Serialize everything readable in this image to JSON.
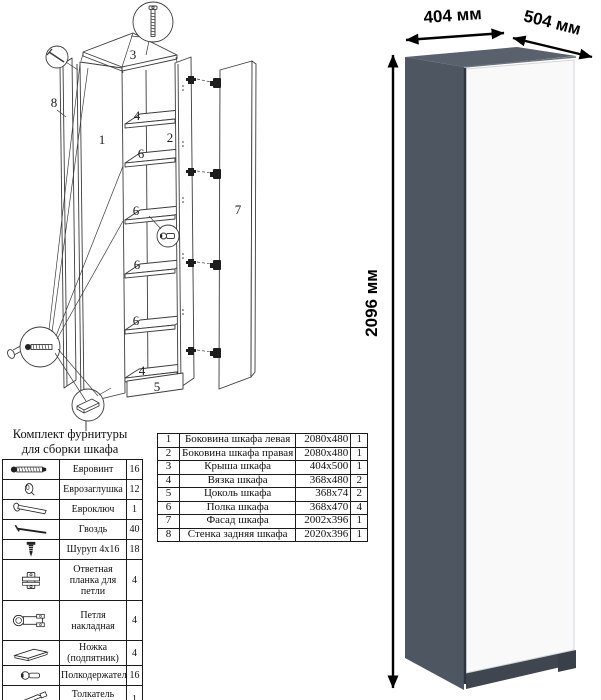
{
  "diagram": {
    "numbers": {
      "1": "1",
      "2": "2",
      "3": "3",
      "4": "4",
      "5": "5",
      "6": "6",
      "7": "7",
      "8": "8"
    }
  },
  "hardware_kit": {
    "title_line1": "Комплект фурнитуры",
    "title_line2": "для сборки шкафа",
    "items": [
      {
        "icon": "euro-screw-icon",
        "name": "Евровинт",
        "qty": "16"
      },
      {
        "icon": "cap-icon",
        "name": "Еврозаглушка",
        "qty": "12"
      },
      {
        "icon": "hex-key-icon",
        "name": "Евроключ",
        "qty": "1"
      },
      {
        "icon": "nail-icon",
        "name": "Гвоздь",
        "qty": "40"
      },
      {
        "icon": "screw-icon",
        "name": "Шуруп 4x16",
        "qty": "18"
      },
      {
        "icon": "hinge-plate-icon",
        "name": "Ответная планка для петли",
        "qty": "4"
      },
      {
        "icon": "hinge-icon",
        "name": "Петля накладная",
        "qty": "4"
      },
      {
        "icon": "foot-icon",
        "name": "Ножка (подпятник)",
        "qty": "4"
      },
      {
        "icon": "shelf-pin-icon",
        "name": "Полкодержатель",
        "qty": "16"
      },
      {
        "icon": "push-rod-icon",
        "name": "Толкатель (пуш)",
        "qty": "1"
      }
    ]
  },
  "parts_table": {
    "rows": [
      {
        "num": "1",
        "name": "Боковина шкафа левая",
        "size": "2080x480",
        "qty": "1"
      },
      {
        "num": "2",
        "name": "Боковина шкафа правая",
        "size": "2080x480",
        "qty": "1"
      },
      {
        "num": "3",
        "name": "Крыша шкафа",
        "size": "404x500",
        "qty": "1"
      },
      {
        "num": "4",
        "name": "Вязка шкафа",
        "size": "368x480",
        "qty": "2"
      },
      {
        "num": "5",
        "name": "Цоколь шкафа",
        "size": "368x74",
        "qty": "2"
      },
      {
        "num": "6",
        "name": "Полка шкафа",
        "size": "368x470",
        "qty": "4"
      },
      {
        "num": "7",
        "name": "Фасад шкафа",
        "size": "2002x396",
        "qty": "1"
      },
      {
        "num": "8",
        "name": "Стенка задняя шкафа",
        "size": "2020x396",
        "qty": "1"
      }
    ]
  },
  "render": {
    "width_label": "404 мм",
    "depth_label": "504 мм",
    "height_label": "2096 мм",
    "colors": {
      "side": "#4e5661",
      "top": "#59616c",
      "door": "#f9f9f9",
      "plinth": "#3f464f",
      "seam": "#2f3640"
    }
  }
}
